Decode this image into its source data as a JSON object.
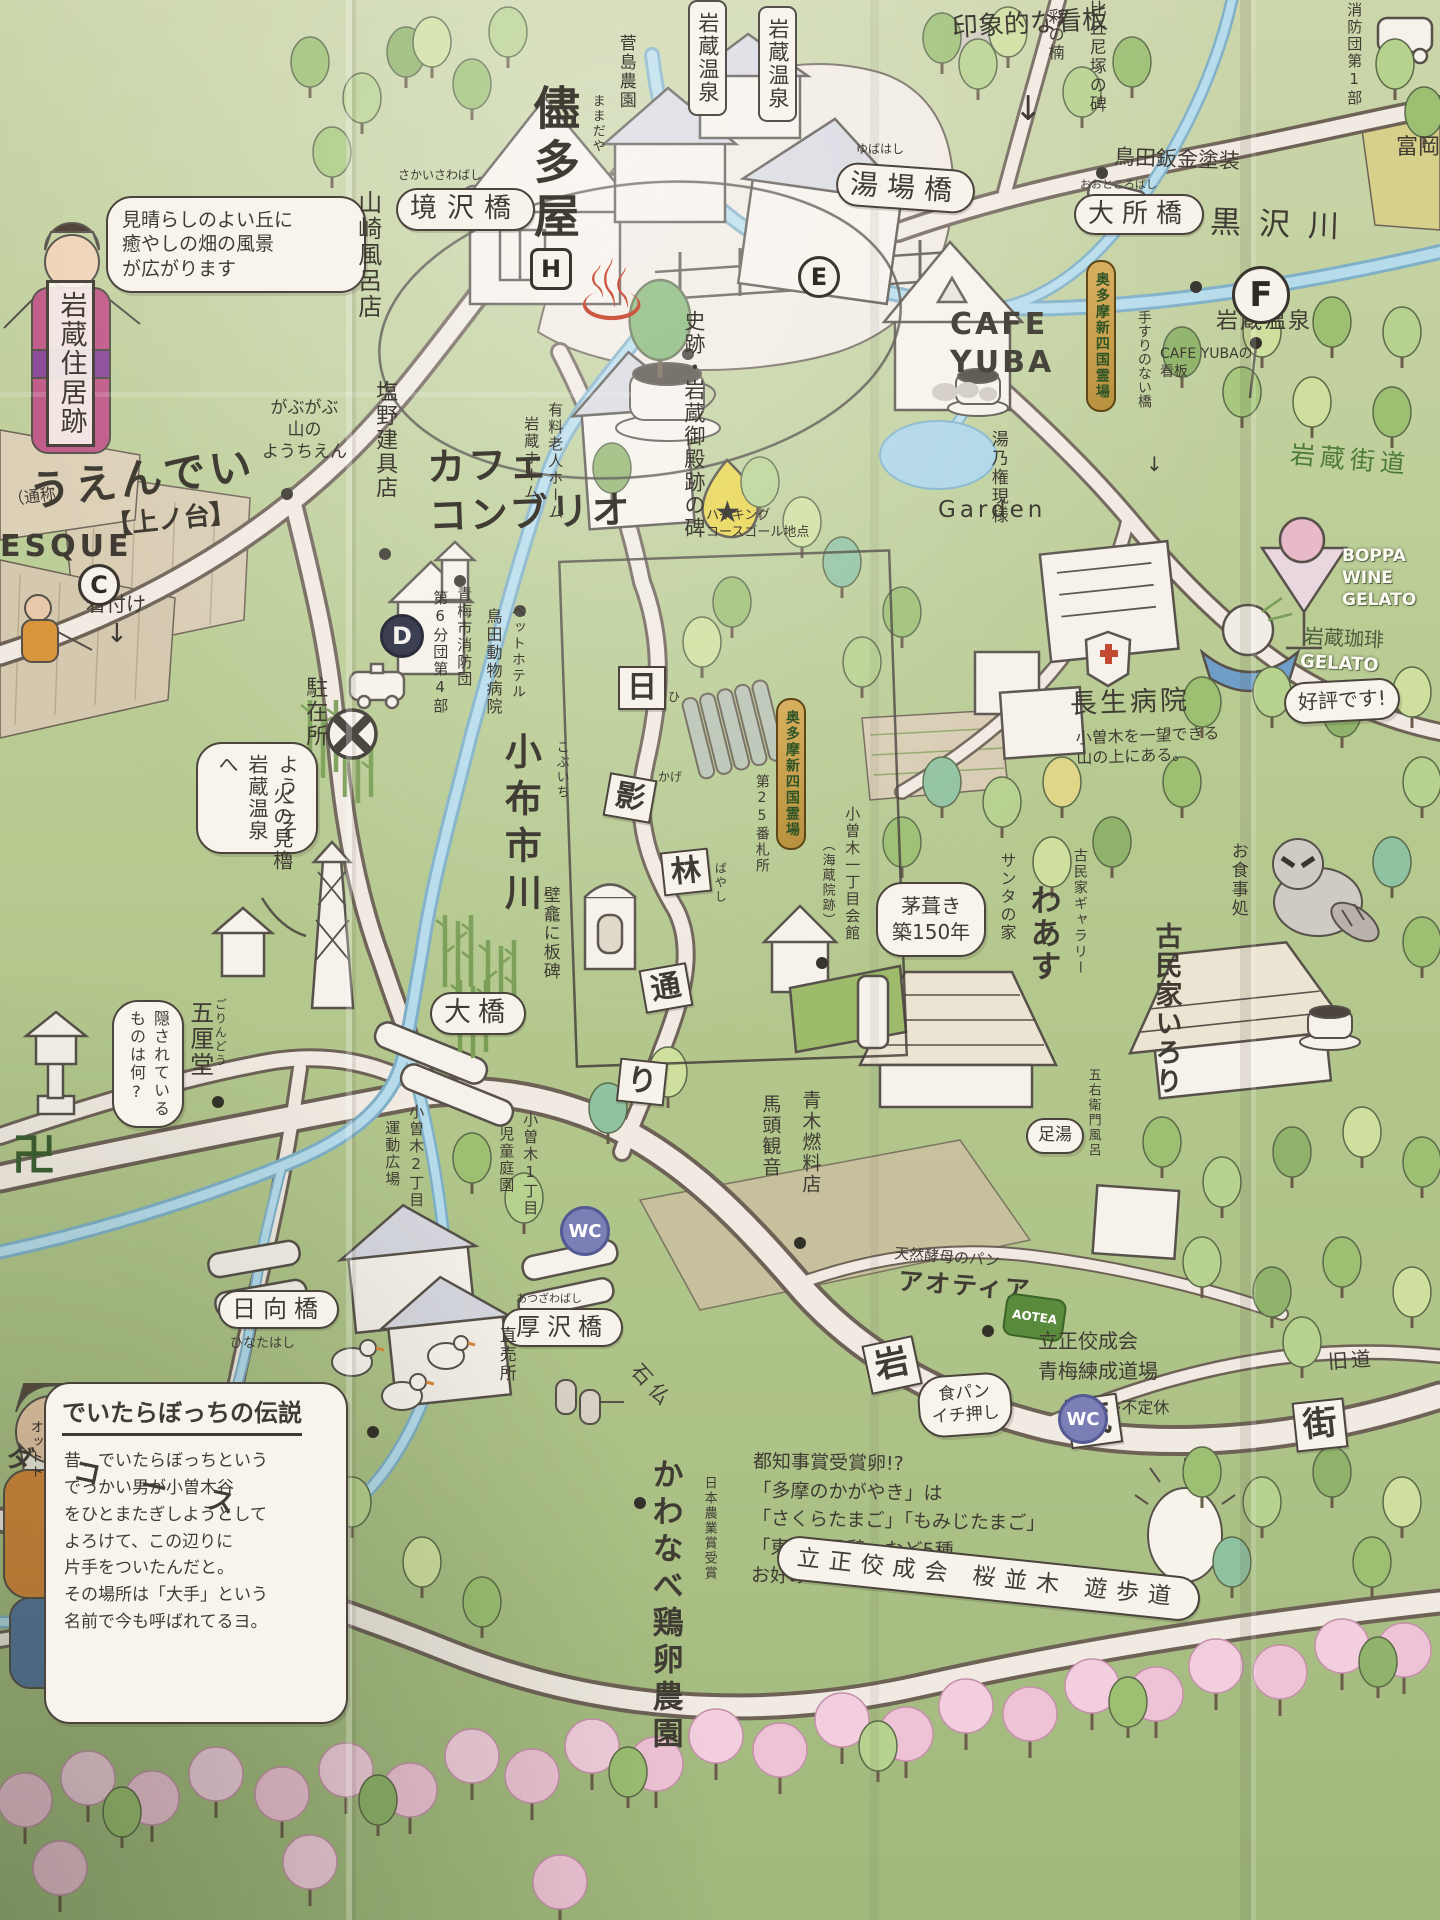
{
  "mk": {
    "f": "F",
    "h": "H",
    "e": "E",
    "c": "C",
    "d": "D",
    "wc": "WC",
    "manji": "卍",
    "onsen": "♨",
    "down": "↓",
    "star": "★"
  },
  "tl": {
    "esque": "ESQUE",
    "kitsuke": "着付け",
    "kanban": "印象的な看板",
    "cafe_combrio": "カフェ\nコンブリオ",
    "miharashi": "見晴らしのよい丘に\n癒やしの畑の風景\nが広がります",
    "yamazaki": "山崎風呂店",
    "sakaisawa_f": "さかいさわばし",
    "sakaisawa": "境沢橋",
    "jukyoato": "岩蔵住居跡",
    "tsusho": "（通称）",
    "uendei": "うえんでい",
    "uenodai": "【上ノ台】",
    "gabugabu": "がぶがぶ\n山の\nようちえん",
    "shiono": "塩野建具店"
  },
  "tc": {
    "mamadaya_f": "ままだや",
    "mamadaya": "儘多屋",
    "sugashima": "菅島農園",
    "onsen1": "岩蔵温泉",
    "onsen2": "岩蔵温泉",
    "yubabashi_f": "ゆばはし",
    "yubabashi": "湯場橋",
    "shiseki": "史跡・岩蔵御殿跡の碑",
    "rojin": "有料老人ホーム",
    "iwakura_home": "岩蔵ホーム"
  },
  "tr": {
    "ayano": "彩の楠",
    "bikuni": "比丘尼塚の碑",
    "bankin": "鳥田鈑金塗装",
    "odokoro_f": "おおところばし",
    "odokoro": "大所橋",
    "kurosawa": "黒沢川",
    "shobo1": "消防団第1部",
    "tomioka": "富岡"
  },
  "rm": {
    "cafe_yuba": "CAFE\nYUBA",
    "yuba_sign": "CAFE YUBAの\n看板",
    "tesuri": "手すりのない橋",
    "onsen3": "岩蔵温泉",
    "reijo_n": "奥多摩新四国霊場",
    "yunogongen": "湯乃権現様",
    "garden": "Garden",
    "goal": "ハイキング\nコースゴール地点",
    "kaido_green": "岩蔵街道",
    "boppa": "BOPPA\nWINE\nGELATO",
    "coffee": "岩蔵珈琲",
    "gelato": "GELATO",
    "kohyo": "好評です!",
    "chosei": "長生病院",
    "chosei_n": "小曽木を一望できる\n山の上にある。"
  },
  "lm": {
    "welcome": "ようこそ\n岩蔵温泉\nへ",
    "chuzai": "駐在所",
    "hinomi": "火の見櫓",
    "pet": "ペットホテル",
    "torita_ah": "鳥田動物病院",
    "shobo6": "青梅市消防団",
    "dai6": "第6分団第4部",
    "kobuichi_f": "こぶいち",
    "kobuichi": "小布市川",
    "gorindo_f": "ごりんどう",
    "gorindo": "五厘堂",
    "kakusare": "隠されている\nものは何?"
  },
  "ct": {
    "hekigan": "壁龕に板碑",
    "ohashi": "大橋",
    "reijo": "奥多摩新四国霊場",
    "fudasho": "第25番札所",
    "kaikan": "小曽木一丁目会館",
    "kaizoin": "（海蔵院跡）",
    "kayabuki": "茅葺き\n築150年",
    "santa": "サンタの家",
    "gallery": "古民家ギャラリー",
    "waasu": "わあす",
    "irori": "古民家いろり",
    "oshokuji": "お食事処",
    "ashiyu": "足湯",
    "goemon": "五右衛門風呂",
    "bato": "馬頭観音",
    "aoki": "青木燃料店",
    "hi": "日",
    "kage": "影",
    "hayashi": "林",
    "tori": "通",
    "ri": "り",
    "hi_f": "ひ",
    "kage_f": "かげ",
    "hayashi_f": "ばやし"
  },
  "bt": {
    "kodomo1": "小曽木1丁目",
    "kodomo2": "児童庭園",
    "undo1": "小曽木2丁目",
    "undo2": "運動広場",
    "atsuzawa_f": "あつざわばし",
    "atsuzawa": "厚沢橋",
    "sekibutsu": "石仏",
    "hinata": "日向橋",
    "hinata_f": "ひなたはし",
    "aotea_l": "天然酵母のパン",
    "aotea": "アオティア",
    "aotea_logo": "AOTEA",
    "shokupan": "食パン\nイチ押し",
    "kyudo": "旧道",
    "kawanabe": "かわなべ鶏卵農園",
    "chokubai": "直売所",
    "nogyo": "日本農業賞受賞",
    "egg": "都知事賞受賞卵!?\n「多摩のかがやき」は\n「さくらたまご」「もみじたまご」\n「東京烏骨鶏」など5種\nお好みの卵をどうぞ…",
    "deitara_t": "でいたらぼっちの伝説",
    "deitara": "昔、でいたらぼっちという\nでっかい男が小曽木谷\nをひとまたぎしようとして\nよろけて、この辺りに\n片手をついたんだと。\nその場所は「大手」という\n名前で今も呼ばれてるヨ。",
    "ottoto": "オットト",
    "da_course": "ダ コ ー ス",
    "rissho": "立正佼成会\n青梅練成道場",
    "futeikyu": "※不定休",
    "sakura_r": "立正佼成会 桜並木 遊歩道",
    "iwa": "岩",
    "kura": "蔵",
    "machi": "街"
  },
  "colors": {
    "paper": "#b8cb92",
    "road": "#f1eae2",
    "river": "#a9d3e6",
    "gold": "#c89c4a",
    "wc_badge": "#7b7fb5",
    "onsen_red": "#cc5742",
    "sakura": "#efc3d6"
  }
}
